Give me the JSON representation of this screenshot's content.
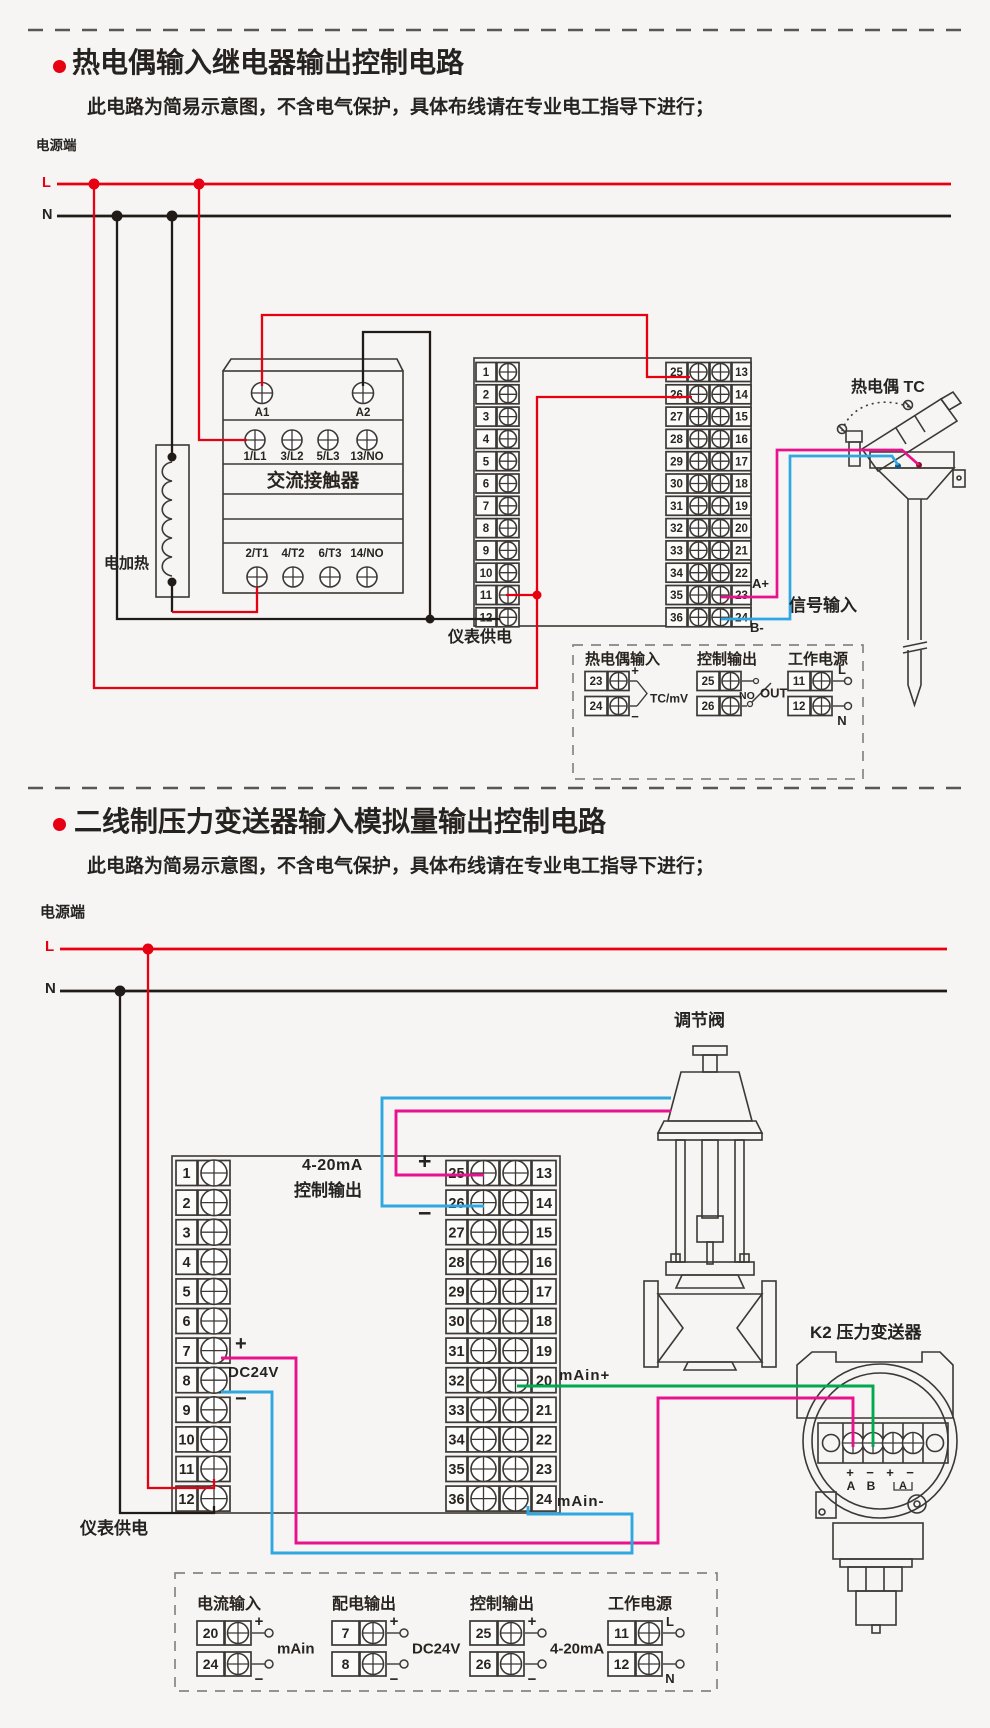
{
  "colors": {
    "red": "#e60012",
    "black": "#211b18",
    "magenta": "#e8128c",
    "blue": "#2fa8e1",
    "green": "#00a84f",
    "line": "#3c3835"
  },
  "sections": [
    {
      "title": "热电偶输入继电器输出控制电路",
      "note": "此电路为简易示意图，不含电气保护，具体布线请在专业电工指导下进行；"
    },
    {
      "title": "二线制压力变送器输入模拟量输出控制电路",
      "note": "此电路为简易示意图，不含电气保护，具体布线请在专业电工指导下进行；"
    }
  ],
  "diagram1": {
    "power_label": "电源端",
    "l": "L",
    "n": "N",
    "heater_label": "电加热",
    "meter_power_label": "仪表供电",
    "contactor": {
      "name": "交流接触器",
      "coil_terminals": [
        "A1",
        "A2"
      ],
      "input_terminals": [
        "1/L1",
        "3/L2",
        "5/L3",
        "13/NO"
      ],
      "output_terminals": [
        "2/T1",
        "4/T2",
        "6/T3",
        "14/NO"
      ]
    },
    "strips": {
      "left": [
        1,
        2,
        3,
        4,
        5,
        6,
        7,
        8,
        9,
        10,
        11,
        12
      ],
      "right_left": [
        25,
        26,
        27,
        28,
        29,
        30,
        31,
        32,
        33,
        34,
        35,
        36
      ],
      "right_right": [
        13,
        14,
        15,
        16,
        17,
        18,
        19,
        20,
        21,
        22,
        23,
        24
      ]
    },
    "signal": {
      "a_plus": "A+",
      "b_minus": "B-",
      "label": "信号输入"
    },
    "tc_label": "热电偶 TC",
    "legend": {
      "items": [
        {
          "title": "热电偶输入",
          "style": "brace",
          "terminals": [
            {
              "no": "23",
              "tag": "+"
            },
            {
              "no": "24",
              "tag": "−"
            }
          ],
          "note": "TC/mV"
        },
        {
          "title": "控制输出",
          "style": "relay",
          "terminals": [
            {
              "no": "25",
              "tag": ""
            },
            {
              "no": "26",
              "tag": ""
            }
          ],
          "no_label": "NO",
          "note": "OUT"
        },
        {
          "title": "工作电源",
          "style": "circles",
          "terminals": [
            {
              "no": "11",
              "tag": "L"
            },
            {
              "no": "12",
              "tag": "N"
            }
          ]
        }
      ]
    }
  },
  "diagram2": {
    "power_label": "电源端",
    "l": "L",
    "n": "N",
    "output_range": "4-20mA",
    "output_label": "控制输出",
    "plus": "+",
    "minus": "−",
    "dc24v": "DC24V",
    "main_plus": "mAin+",
    "main_minus": "mAin-",
    "meter_power_label": "仪表供电",
    "valve_label": "调节阀",
    "transmitter_label": "K2 压力变送器",
    "transmitter_signs": [
      "+",
      "−",
      "+",
      "−"
    ],
    "transmitter_ports": [
      "A",
      "B"
    ],
    "transmitter_meter": "A",
    "strips": {
      "left": [
        1,
        2,
        3,
        4,
        5,
        6,
        7,
        8,
        9,
        10,
        11,
        12
      ],
      "right_left": [
        25,
        26,
        27,
        28,
        29,
        30,
        31,
        32,
        33,
        34,
        35,
        36
      ],
      "right_right": [
        13,
        14,
        15,
        16,
        17,
        18,
        19,
        20,
        21,
        22,
        23,
        24
      ]
    },
    "legend": {
      "items": [
        {
          "title": "电流输入",
          "style": "circles",
          "terminals": [
            {
              "no": "20",
              "tag": "+"
            },
            {
              "no": "24",
              "tag": "−"
            }
          ],
          "note": "mAin"
        },
        {
          "title": "配电输出",
          "style": "circles",
          "terminals": [
            {
              "no": "7",
              "tag": "+"
            },
            {
              "no": "8",
              "tag": "−"
            }
          ],
          "note": "DC24V"
        },
        {
          "title": "控制输出",
          "style": "circles",
          "terminals": [
            {
              "no": "25",
              "tag": "+"
            },
            {
              "no": "26",
              "tag": "−"
            }
          ],
          "note": "4-20mA"
        },
        {
          "title": "工作电源",
          "style": "circles",
          "terminals": [
            {
              "no": "11",
              "tag": "L"
            },
            {
              "no": "12",
              "tag": "N"
            }
          ]
        }
      ]
    }
  }
}
